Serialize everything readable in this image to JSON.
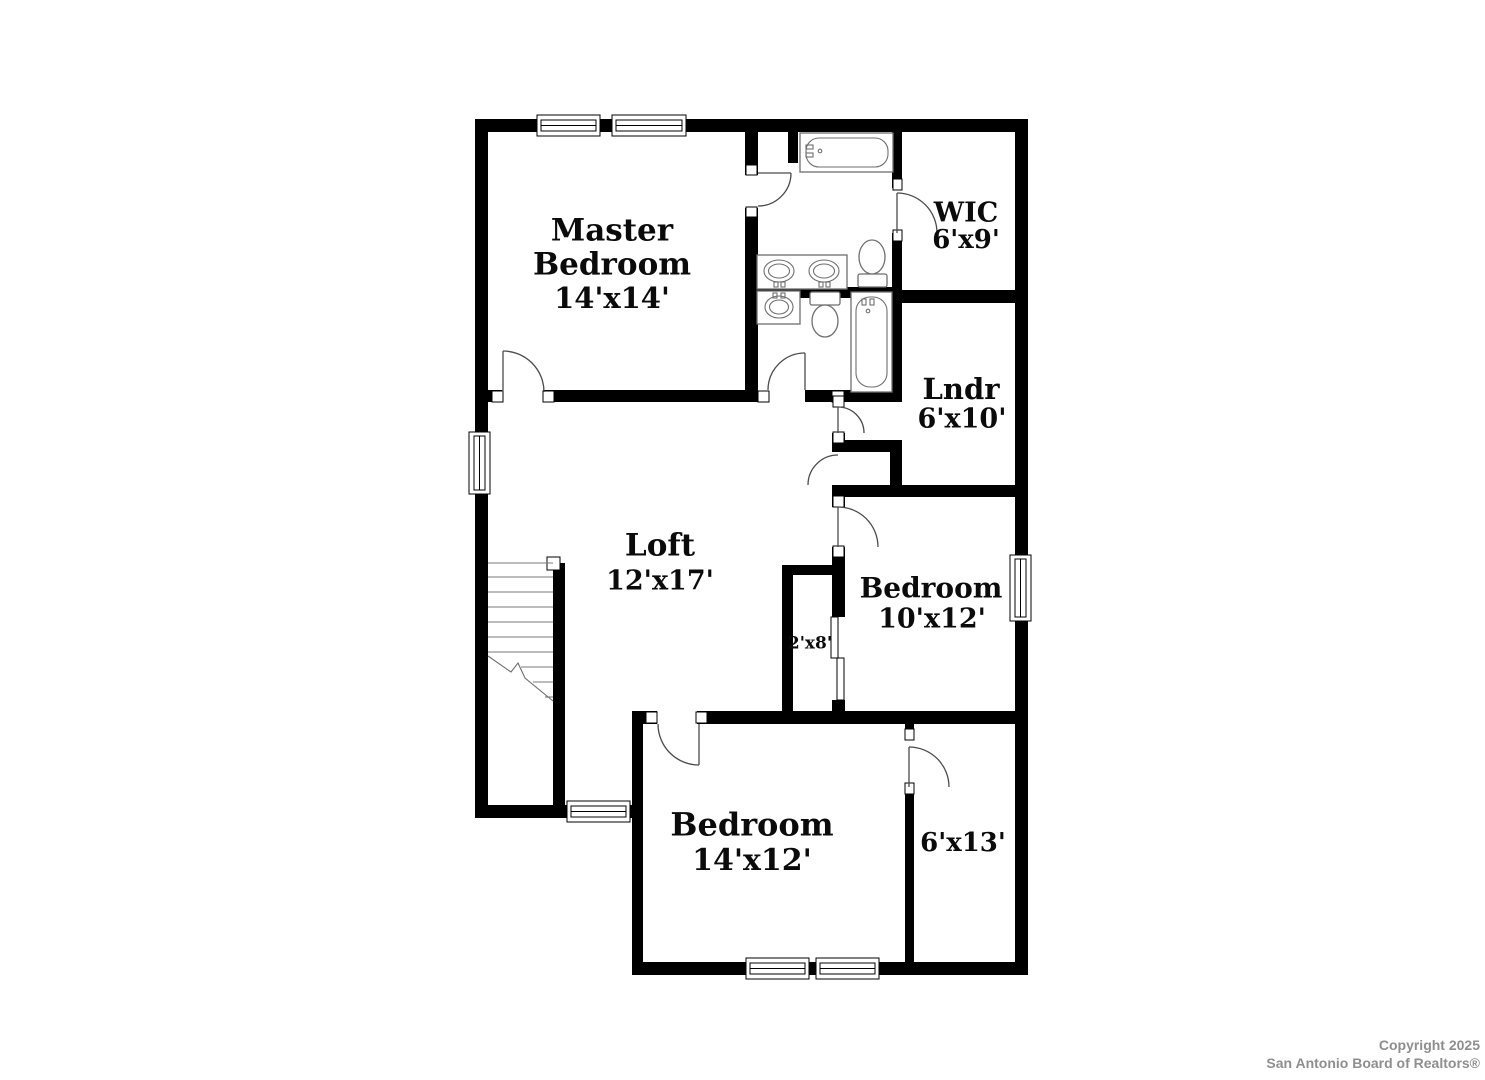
{
  "floor_plan": {
    "wall_color": "#000000",
    "background": "#ffffff",
    "rooms": [
      {
        "id": "master-bedroom",
        "name_lines": [
          "Master",
          "Bedroom"
        ],
        "dims": "14'x14'"
      },
      {
        "id": "wic",
        "name_lines": [
          "WIC"
        ],
        "dims": "6'x9'"
      },
      {
        "id": "laundry",
        "name_lines": [
          "Lndr"
        ],
        "dims": "6'x10'"
      },
      {
        "id": "loft",
        "name_lines": [
          "Loft"
        ],
        "dims": "12'x17'"
      },
      {
        "id": "bedroom-right",
        "name_lines": [
          "Bedroom"
        ],
        "dims": "10'x12'"
      },
      {
        "id": "closet",
        "name_lines": [],
        "dims": "2'x8'"
      },
      {
        "id": "bedroom-bottom",
        "name_lines": [
          "Bedroom"
        ],
        "dims": "14'x12'"
      },
      {
        "id": "bonus-room",
        "name_lines": [],
        "dims": "6'x13'"
      }
    ]
  },
  "watermark": {
    "line1": "Copyright 2025",
    "line2": "San Antonio Board of Realtors®",
    "color": "#8e8e8e"
  }
}
